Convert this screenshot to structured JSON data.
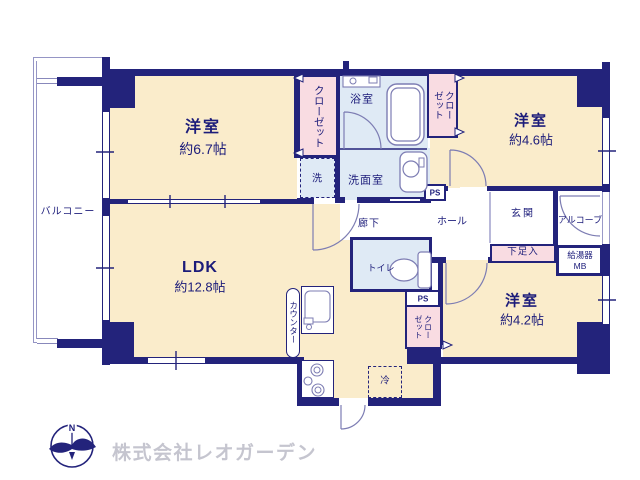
{
  "floorplan": {
    "balcony": "バルコニー",
    "rooms": {
      "western1": {
        "name": "洋室",
        "size": "約6.7帖"
      },
      "western2": {
        "name": "洋室",
        "size": "約4.6帖"
      },
      "western3": {
        "name": "洋室",
        "size": "約4.2帖"
      },
      "ldk": {
        "name": "LDK",
        "size": "約12.8帖"
      }
    },
    "labels": {
      "closet": "クローゼット",
      "bath": "浴室",
      "washroom": "洗面室",
      "laundry": "洗",
      "toilet": "トイレ",
      "hall": "ホール",
      "corridor": "廊下",
      "entrance": "玄関",
      "alcove": "アルコーブ",
      "shoe_cabinet": "下足入",
      "water_heater": "給湯器",
      "meter_box": "MB",
      "pipe_space": "PS",
      "counter": "カウンター",
      "refrigerator": "冷"
    },
    "colors": {
      "wall": "#23237b",
      "room_fill": "#faeccb",
      "closet_fill": "#f9dce2",
      "wet_area_fill": "#dfeaf5",
      "fixture_line": "#7d7db3"
    }
  },
  "footer": {
    "compass_north": "N",
    "company": "株式会社レオガーデン"
  }
}
